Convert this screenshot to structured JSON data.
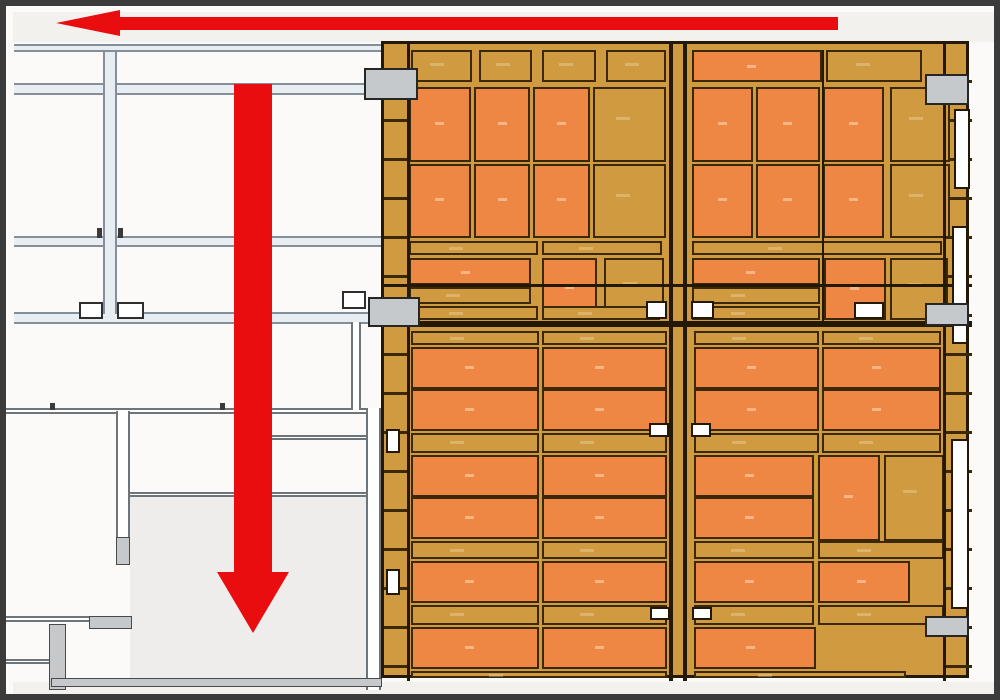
{
  "colors": {
    "bg": "#fbfaf8",
    "frame": "#3b3b3b",
    "strip": "#f2f1ee",
    "steel": "#e8edf2",
    "steeledge": "#83909b",
    "walledge": "#6d747a",
    "gray": "#c6c9cc",
    "room": "#eeedeb",
    "tan": "#cf9a40",
    "orange": "#ee8743",
    "line": "#241806",
    "palletedge": "#3a2807",
    "red": "#e90d10",
    "white": "#ffffff"
  },
  "strips": {
    "top": [
      7,
      6,
      986,
      30
    ],
    "bottom": [
      7,
      676,
      986,
      18
    ]
  },
  "plan": {
    "beams_h": [
      [
        8,
        38,
        369,
        8
      ],
      [
        8,
        77,
        369,
        12
      ],
      [
        8,
        230,
        369,
        11
      ],
      [
        8,
        306,
        369,
        12
      ]
    ],
    "beams_v": [
      [
        97,
        46,
        14,
        262
      ]
    ],
    "walls_h": [
      [
        0,
        402,
        374,
        6
      ],
      [
        263,
        429,
        110,
        5
      ],
      [
        124,
        486,
        250,
        5
      ],
      [
        0,
        610,
        86,
        6
      ],
      [
        0,
        653,
        48,
        5
      ]
    ],
    "walls_v": [
      [
        110,
        405,
        14,
        150
      ],
      [
        345,
        316,
        10,
        88
      ],
      [
        360,
        402,
        15,
        282
      ]
    ],
    "wall_fills": [
      [
        110,
        531,
        14,
        28
      ],
      [
        83,
        610,
        43,
        13
      ],
      [
        43,
        618,
        17,
        66
      ],
      [
        45,
        672,
        331,
        9
      ]
    ],
    "room_fill": [
      124,
      491,
      238,
      183
    ],
    "ticks": [
      [
        91,
        222,
        5,
        10
      ],
      [
        112,
        222,
        5,
        10
      ],
      [
        44,
        397,
        5,
        7
      ],
      [
        214,
        397,
        5,
        7
      ]
    ],
    "columns": [
      [
        358,
        62,
        54,
        32
      ],
      [
        362,
        291,
        52,
        30
      ],
      [
        919,
        68,
        44,
        31
      ],
      [
        919,
        297,
        44,
        23
      ],
      [
        919,
        610,
        44,
        21
      ]
    ],
    "white_squares": [
      [
        73,
        296,
        24,
        17
      ],
      [
        111,
        296,
        27,
        17
      ],
      [
        336,
        285,
        24,
        18
      ]
    ]
  },
  "warehouse": {
    "frame": [
      375,
      35,
      588,
      637
    ],
    "edge_ticks": [
      [
        0,
        0,
        23,
        637
      ],
      [
        562,
        0,
        26,
        637
      ]
    ],
    "vlines": [
      [
        23,
        0,
        3,
        637
      ],
      [
        285,
        0,
        4,
        637
      ],
      [
        299,
        0,
        4,
        637
      ],
      [
        559,
        0,
        3,
        637
      ],
      [
        438,
        6,
        2,
        272
      ]
    ],
    "hlines": [
      [
        0,
        240,
        588,
        3
      ],
      [
        0,
        277,
        588,
        6
      ]
    ],
    "rows": [
      {
        "y": 6,
        "h": 32,
        "cells": [
          [
            27,
            61,
            "t"
          ],
          [
            95,
            53,
            "t"
          ],
          [
            158,
            54,
            "t"
          ],
          [
            222,
            60,
            "t"
          ],
          [
            308,
            130,
            "b"
          ],
          [
            442,
            96,
            "t"
          ]
        ]
      },
      {
        "y": 43,
        "h": 75,
        "cells": [
          [
            25,
            62,
            "b"
          ],
          [
            90,
            56,
            "b"
          ],
          [
            149,
            57,
            "b"
          ],
          [
            209,
            73,
            "t"
          ],
          [
            308,
            61,
            "b"
          ],
          [
            372,
            64,
            "b"
          ],
          [
            439,
            61,
            "b"
          ],
          [
            506,
            60,
            "t"
          ]
        ]
      },
      {
        "y": 120,
        "h": 74,
        "cells": [
          [
            25,
            62,
            "b"
          ],
          [
            90,
            56,
            "b"
          ],
          [
            149,
            57,
            "b"
          ],
          [
            209,
            73,
            "t"
          ],
          [
            308,
            61,
            "b"
          ],
          [
            372,
            64,
            "b"
          ],
          [
            439,
            61,
            "b"
          ],
          [
            506,
            60,
            "t"
          ]
        ]
      },
      {
        "y": 197,
        "h": 14,
        "cells": [
          [
            25,
            129,
            "t"
          ],
          [
            158,
            120,
            "t"
          ],
          [
            308,
            250,
            "t"
          ]
        ]
      },
      {
        "y": 214,
        "h": 27,
        "cells": [
          [
            25,
            122,
            "b"
          ],
          [
            158,
            55,
            "b",
            60
          ],
          [
            220,
            60,
            "t",
            60
          ],
          [
            308,
            128,
            "b"
          ],
          [
            440,
            62,
            "b",
            62
          ],
          [
            506,
            58,
            "t",
            62
          ]
        ]
      },
      {
        "y": 243,
        "h": 17,
        "cells": [
          [
            25,
            122,
            "t"
          ],
          [
            308,
            128,
            "t"
          ]
        ]
      },
      {
        "y": 262,
        "h": 14,
        "cells": [
          [
            25,
            129,
            "t"
          ],
          [
            158,
            118,
            "t"
          ],
          [
            308,
            128,
            "t"
          ]
        ]
      },
      {
        "y": 287,
        "h": 14,
        "cells": [
          [
            27,
            128,
            "t"
          ],
          [
            158,
            125,
            "t"
          ],
          [
            310,
            125,
            "t"
          ],
          [
            438,
            119,
            "t"
          ]
        ]
      },
      {
        "y": 303,
        "h": 42,
        "cells": [
          [
            27,
            128,
            "b"
          ],
          [
            158,
            125,
            "b"
          ],
          [
            310,
            125,
            "b"
          ],
          [
            438,
            119,
            "b"
          ]
        ]
      },
      {
        "y": 345,
        "h": 42,
        "cells": [
          [
            27,
            128,
            "b"
          ],
          [
            158,
            125,
            "b"
          ],
          [
            310,
            125,
            "b"
          ],
          [
            438,
            119,
            "b"
          ]
        ]
      },
      {
        "y": 389,
        "h": 20,
        "cells": [
          [
            27,
            128,
            "t"
          ],
          [
            158,
            125,
            "t"
          ],
          [
            310,
            125,
            "t"
          ],
          [
            438,
            119,
            "t"
          ]
        ]
      },
      {
        "y": 411,
        "h": 42,
        "cells": [
          [
            27,
            128,
            "b"
          ],
          [
            158,
            125,
            "b"
          ],
          [
            310,
            120,
            "b"
          ],
          [
            434,
            62,
            "b",
            86
          ],
          [
            500,
            60,
            "t",
            86
          ]
        ]
      },
      {
        "y": 453,
        "h": 42,
        "cells": [
          [
            27,
            128,
            "b"
          ],
          [
            158,
            125,
            "b"
          ],
          [
            310,
            120,
            "b"
          ]
        ]
      },
      {
        "y": 497,
        "h": 18,
        "cells": [
          [
            27,
            128,
            "t"
          ],
          [
            158,
            125,
            "t"
          ],
          [
            310,
            120,
            "t"
          ],
          [
            434,
            126,
            "t"
          ]
        ]
      },
      {
        "y": 517,
        "h": 42,
        "cells": [
          [
            27,
            128,
            "b"
          ],
          [
            158,
            125,
            "b"
          ],
          [
            310,
            120,
            "b"
          ],
          [
            434,
            92,
            "b"
          ]
        ]
      },
      {
        "y": 561,
        "h": 20,
        "cells": [
          [
            27,
            128,
            "t"
          ],
          [
            158,
            125,
            "t"
          ],
          [
            310,
            120,
            "t"
          ],
          [
            434,
            126,
            "t"
          ]
        ]
      },
      {
        "y": 583,
        "h": 42,
        "cells": [
          [
            27,
            128,
            "b"
          ],
          [
            158,
            125,
            "b"
          ],
          [
            310,
            122,
            "b"
          ]
        ]
      },
      {
        "y": 627,
        "h": 7,
        "cells": [
          [
            27,
            256,
            "t"
          ],
          [
            310,
            212,
            "t"
          ]
        ]
      }
    ],
    "white_slots": [
      [
        262,
        257,
        21,
        18
      ],
      [
        307,
        257,
        23,
        18
      ],
      [
        265,
        379,
        20,
        14
      ],
      [
        307,
        379,
        20,
        14
      ],
      [
        266,
        563,
        20,
        13
      ],
      [
        308,
        563,
        20,
        13
      ],
      [
        470,
        258,
        30,
        17
      ],
      [
        2,
        385,
        14,
        24
      ],
      [
        2,
        525,
        14,
        26
      ],
      [
        570,
        65,
        16,
        80
      ],
      [
        568,
        182,
        16,
        118
      ],
      [
        567,
        395,
        18,
        170
      ]
    ]
  },
  "arrows": {
    "left": {
      "shaft": [
        112,
        11,
        720,
        13
      ],
      "head": {
        "x": 50,
        "y": 4
      }
    },
    "down": {
      "shaft": [
        228,
        78,
        38,
        492
      ],
      "head": {
        "x": 211,
        "y": 566
      }
    }
  }
}
